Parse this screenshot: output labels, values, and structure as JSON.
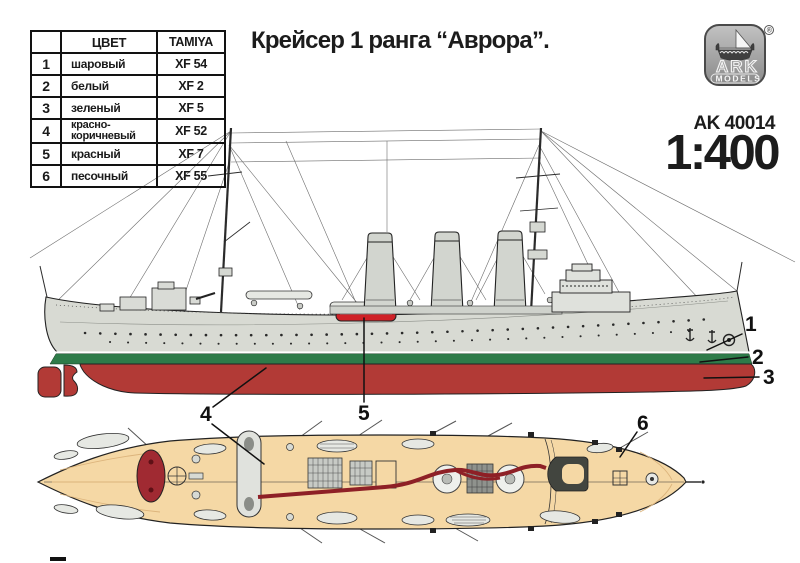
{
  "title": "Крейсер 1 ранга “Аврора”.",
  "brand": {
    "logo_text": "ARK",
    "logo_sub": "MODELS",
    "registered": "®",
    "kit_number": "AK 40014",
    "scale": "1:400"
  },
  "color_table": {
    "headers": [
      "",
      "ЦВЕТ",
      "TAMIYA"
    ],
    "rows": [
      {
        "num": "1",
        "color": "шаровый",
        "tamiya": "XF 54"
      },
      {
        "num": "2",
        "color": "белый",
        "tamiya": "XF 2"
      },
      {
        "num": "3",
        "color": "зеленый",
        "tamiya": "XF 5"
      },
      {
        "num": "4",
        "color": "красно-коричневый",
        "tamiya": "XF 52"
      },
      {
        "num": "5",
        "color": "красный",
        "tamiya": "XF 7"
      },
      {
        "num": "6",
        "color": "песочный",
        "tamiya": "XF 55"
      }
    ]
  },
  "callouts": [
    "1",
    "2",
    "3",
    "4",
    "5",
    "6"
  ],
  "colors": {
    "hull_grey": "#d8dad3",
    "funnel_grey": "#d2d5cf",
    "superstructure_grey": "#dfe1dc",
    "boot_white": "#ffffff",
    "waterline_green": "#2e7b49",
    "hull_red_brown": "#b23a36",
    "boat_red": "#cf2127",
    "deck_sand": "#f5d8a5",
    "deck_oval_red": "#a02a32",
    "deck_stripe_red": "#8e2026",
    "line_black": "#1a1a1a"
  }
}
